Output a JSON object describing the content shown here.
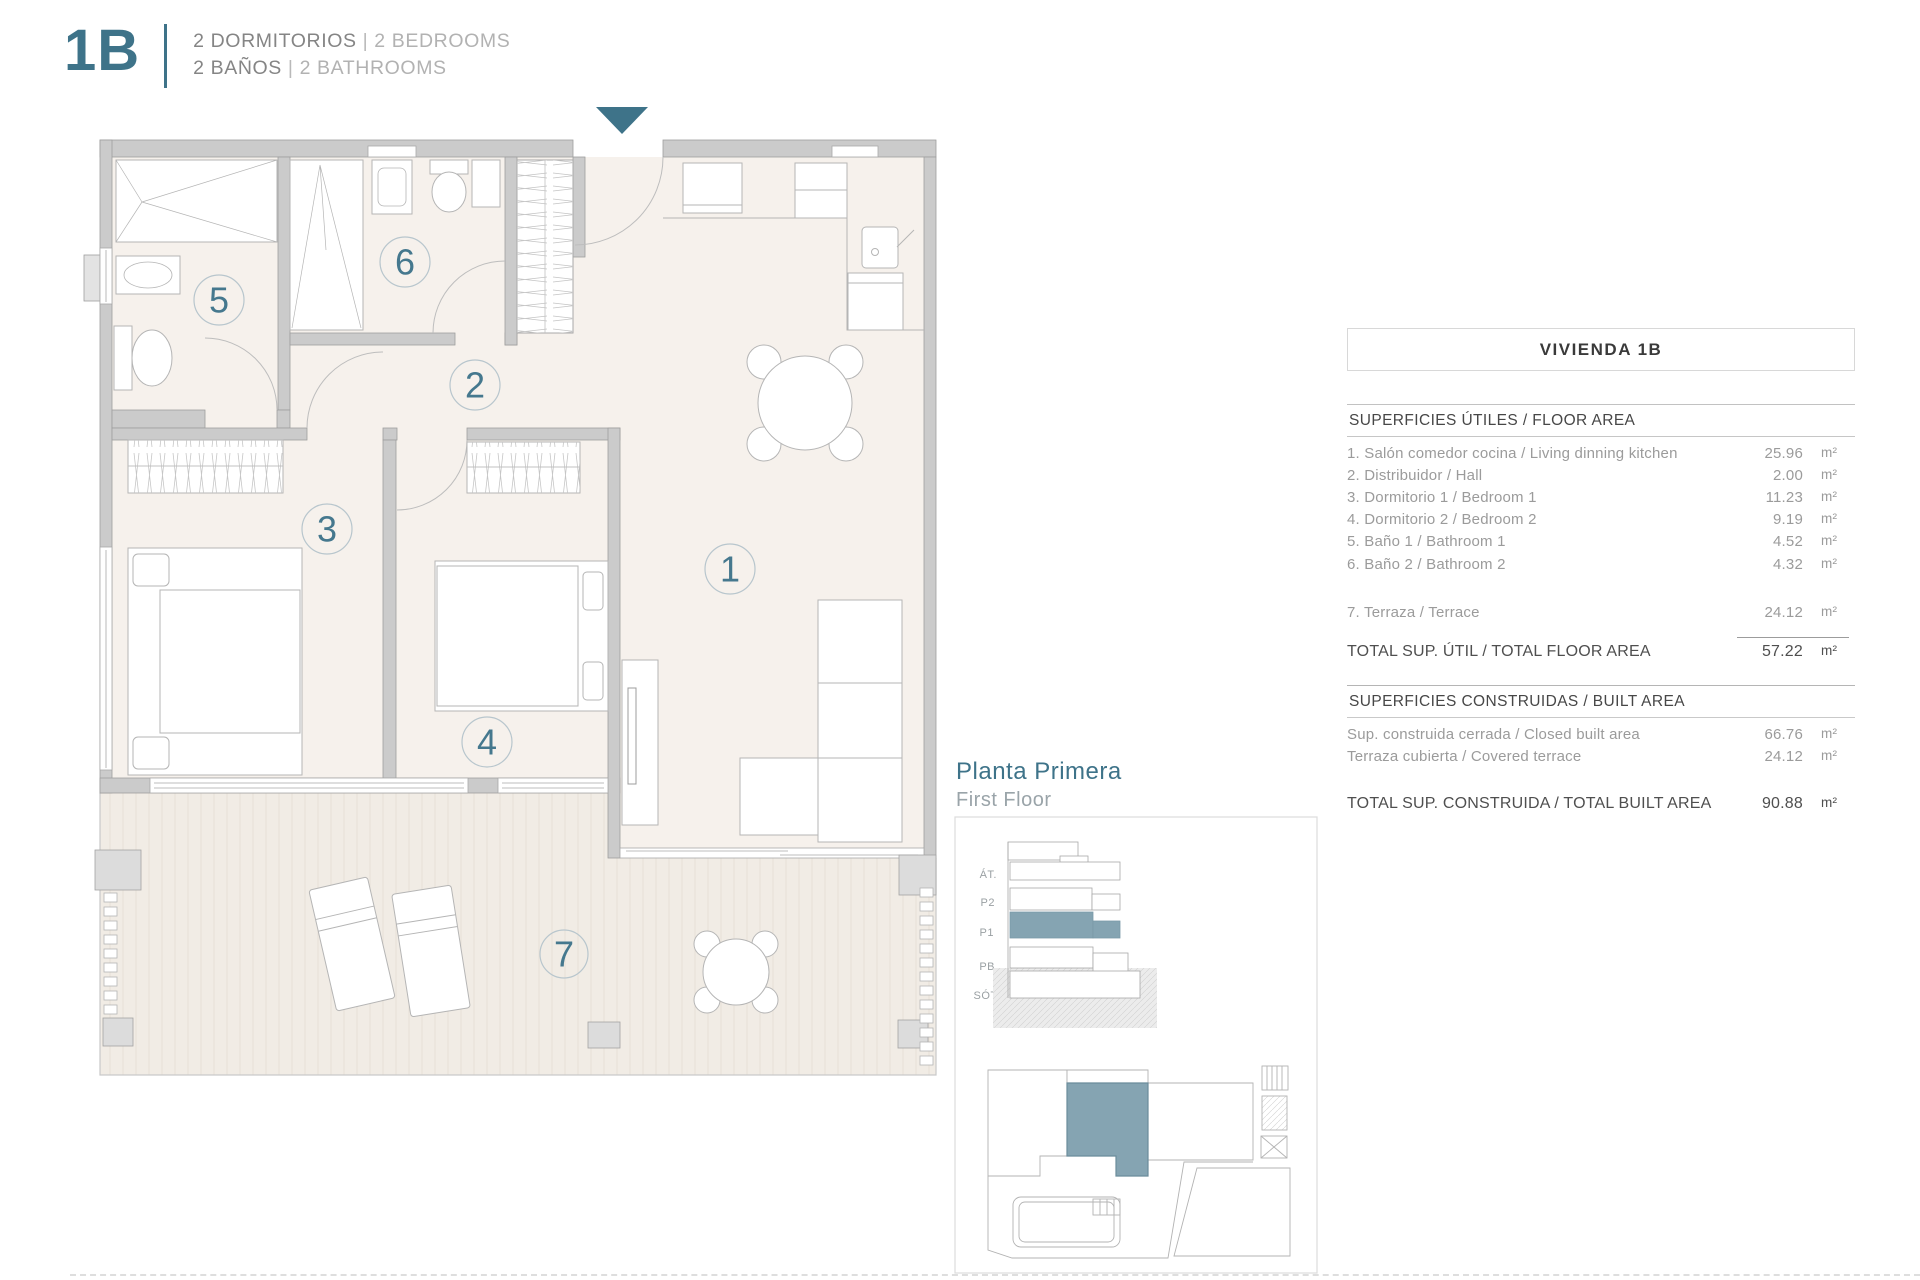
{
  "header": {
    "unit_code": "1B",
    "bedrooms_es": "2 DORMITORIOS",
    "bedrooms_en": "2 BEDROOMS",
    "bathrooms_es": "2 BAÑOS",
    "bathrooms_en": "2 BATHROOMS",
    "separator": "|"
  },
  "floor_plan": {
    "room_numbers": {
      "living": "1",
      "hall": "2",
      "bedroom1": "3",
      "bedroom2": "4",
      "bath1": "5",
      "bath2": "6",
      "terrace": "7"
    }
  },
  "key_plans": {
    "title_es": "Planta Primera",
    "title_en": "First Floor",
    "section_floors": [
      "ÁT.",
      "P2",
      "P1",
      "PB",
      "SÓT."
    ]
  },
  "area_table": {
    "title": "VIVIENDA 1B",
    "floor_area_header": "SUPERFICIES ÚTILES / FLOOR AREA",
    "floor_rows": [
      {
        "label": "1. Salón comedor cocina / Living dinning kitchen",
        "value": "25.96",
        "unit": "m²"
      },
      {
        "label": "2. Distribuidor / Hall",
        "value": "2.00",
        "unit": "m²"
      },
      {
        "label": "3. Dormitorio 1 / Bedroom 1",
        "value": "11.23",
        "unit": "m²"
      },
      {
        "label": "4. Dormitorio 2 / Bedroom 2",
        "value": "9.19",
        "unit": "m²"
      },
      {
        "label": "5. Baño 1 / Bathroom 1",
        "value": "4.52",
        "unit": "m²"
      },
      {
        "label": "6. Baño 2 / Bathroom 2",
        "value": "4.32",
        "unit": "m²"
      },
      {
        "label": "7. Terraza / Terrace",
        "value": "24.12",
        "unit": "m²"
      }
    ],
    "total_floor": {
      "label": "TOTAL SUP. ÚTIL / TOTAL FLOOR AREA",
      "value": "57.22",
      "unit": "m²"
    },
    "built_area_header": "SUPERFICIES CONSTRUIDAS / BUILT AREA",
    "built_rows": [
      {
        "label": "Sup. construida cerrada / Closed built area",
        "value": "66.76",
        "unit": "m²"
      },
      {
        "label": "Terraza cubierta / Covered terrace",
        "value": "24.12",
        "unit": "m²"
      }
    ],
    "total_built": {
      "label": "TOTAL SUP. CONSTRUIDA /  TOTAL BUILT AREA",
      "value": "90.88",
      "unit": "m²"
    }
  },
  "colors": {
    "accent_teal": "#3E7389",
    "unit_highlight": "#85A4B2"
  }
}
